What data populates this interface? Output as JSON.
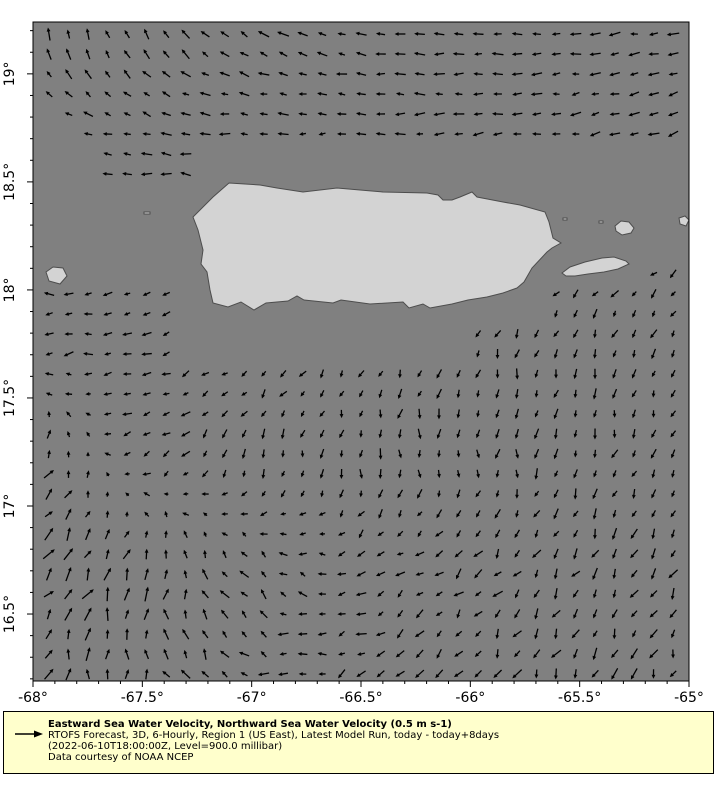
{
  "legend": {
    "title": "Eastward Sea Water Velocity, Northward Sea Water Velocity (0.5 m s-1)",
    "line2": "RTOFS Forecast, 3D, 6-Hourly, Region 1 (US East), Latest Model Run, today - today+8days",
    "line3": "(2022-06-10T18:00:00Z, Level=900.0 millibar)",
    "line4": "Data courtesy of NOAA NCEP",
    "arrow_icon": "quiver-key-arrow-icon"
  },
  "chart_data": {
    "type": "quiver",
    "title": "",
    "subtitle": "",
    "plot": {
      "left": 33,
      "top": 22,
      "width": 656,
      "height": 659
    },
    "x_axis": {
      "label": "",
      "range": [
        -68.0,
        -65.0
      ],
      "major_ticks": [
        -68,
        -67.5,
        -67,
        -66.5,
        -66,
        -65.5,
        -65
      ],
      "tick_labels": [
        "-68°",
        "-67.5°",
        "-67°",
        "-66.5°",
        "-66°",
        "-65.5°",
        "-65°"
      ],
      "minor_step": 0.1
    },
    "y_axis": {
      "label": "",
      "range": [
        16.19,
        19.24
      ],
      "major_ticks": [
        19,
        18.5,
        18,
        17.5,
        17,
        16.5
      ],
      "tick_labels": [
        "19°",
        "18.5°",
        "18°",
        "17.5°",
        "17°",
        "16.5°"
      ],
      "minor_step": 0.1
    },
    "grid": false,
    "colors": {
      "ocean": "#808080",
      "land": "#d3d3d3",
      "coastline": "#4d4d4d",
      "arrows": "#000000",
      "axis": "#000000",
      "legend_bg": "#ffffcc",
      "page_bg": "#ffffff"
    },
    "field": {
      "reference_vector_m_s": 0.5,
      "grid_start_px": [
        16,
        12
      ],
      "grid_step_px": [
        19.5,
        20
      ],
      "grid_cols": 33,
      "grid_rows": 33,
      "coarse_lons": [
        -68,
        -67.5,
        -67,
        -66.5,
        -66,
        -65.5,
        -65
      ],
      "coarse_lats": [
        19.2,
        18.7,
        18.2,
        17.7,
        17.2,
        16.7,
        16.2
      ],
      "angles_deg_ccw_from_east": [
        [
          95,
          120,
          150,
          170,
          180,
          185,
          190
        ],
        [
          160,
          172,
          180,
          183,
          188,
          192,
          200
        ],
        [
          175,
          180,
          185,
          188,
          195,
          205,
          215
        ],
        [
          185,
          195,
          215,
          240,
          255,
          255,
          248
        ],
        [
          60,
          210,
          250,
          270,
          268,
          258,
          248
        ],
        [
          48,
          70,
          130,
          200,
          228,
          238,
          244
        ],
        [
          75,
          105,
          165,
          215,
          235,
          245,
          252
        ]
      ],
      "rel_magnitude": [
        [
          0.7,
          0.65,
          0.6,
          0.55,
          0.55,
          0.55,
          0.6
        ],
        [
          0.6,
          0.55,
          0.5,
          0.5,
          0.5,
          0.5,
          0.55
        ],
        [
          0.5,
          0.45,
          0.4,
          0.4,
          0.4,
          0.45,
          0.5
        ],
        [
          0.5,
          0.45,
          0.45,
          0.45,
          0.5,
          0.5,
          0.5
        ],
        [
          0.75,
          0.5,
          0.5,
          0.5,
          0.5,
          0.5,
          0.5
        ],
        [
          0.95,
          0.85,
          0.6,
          0.5,
          0.55,
          0.6,
          0.6
        ],
        [
          0.8,
          0.75,
          0.55,
          0.5,
          0.6,
          0.6,
          0.6
        ]
      ]
    },
    "land": {
      "features": [
        {
          "name": "puerto-rico",
          "points": [
            [
              196,
              161
            ],
            [
              227,
              163
            ],
            [
              244,
              166
            ],
            [
              270,
              170
            ],
            [
              304,
              166
            ],
            [
              327,
              168
            ],
            [
              350,
              170
            ],
            [
              394,
              171
            ],
            [
              405,
              173
            ],
            [
              410,
              178
            ],
            [
              419,
              178
            ],
            [
              427,
              175
            ],
            [
              439,
              170
            ],
            [
              444,
              175
            ],
            [
              470,
              180
            ],
            [
              487,
              183
            ],
            [
              512,
              190
            ],
            [
              516,
              200
            ],
            [
              520,
              216
            ],
            [
              528,
              221
            ],
            [
              519,
              226
            ],
            [
              514,
              230
            ],
            [
              499,
              246
            ],
            [
              491,
              260
            ],
            [
              484,
              266
            ],
            [
              470,
              271
            ],
            [
              454,
              275
            ],
            [
              435,
              278
            ],
            [
              419,
              282
            ],
            [
              397,
              286
            ],
            [
              390,
              282
            ],
            [
              376,
              286
            ],
            [
              370,
              280
            ],
            [
              337,
              282
            ],
            [
              308,
              278
            ],
            [
              300,
              281
            ],
            [
              271,
              278
            ],
            [
              264,
              274
            ],
            [
              255,
              279
            ],
            [
              233,
              281
            ],
            [
              221,
              288
            ],
            [
              208,
              280
            ],
            [
              195,
              285
            ],
            [
              180,
              281
            ],
            [
              177,
              268
            ],
            [
              174,
              250
            ],
            [
              168,
              242
            ],
            [
              170,
              228
            ],
            [
              165,
              208
            ],
            [
              160,
              195
            ],
            [
              180,
              175
            ]
          ]
        },
        {
          "name": "vieques",
          "points": [
            [
              529,
              251
            ],
            [
              537,
              245
            ],
            [
              552,
              240
            ],
            [
              569,
              236
            ],
            [
              581,
              235
            ],
            [
              593,
              239
            ],
            [
              596,
              242
            ],
            [
              585,
              247
            ],
            [
              571,
              250
            ],
            [
              555,
              252
            ],
            [
              542,
              254
            ],
            [
              533,
              254
            ]
          ]
        },
        {
          "name": "culebra",
          "points": [
            [
              582,
              204
            ],
            [
              588,
              199
            ],
            [
              596,
              200
            ],
            [
              601,
              206
            ],
            [
              598,
              211
            ],
            [
              589,
              213
            ],
            [
              583,
              209
            ]
          ]
        },
        {
          "name": "east-islet",
          "points": [
            [
              646,
              196
            ],
            [
              652,
              194
            ],
            [
              656,
              198
            ],
            [
              653,
              204
            ],
            [
              647,
              202
            ]
          ]
        },
        {
          "name": "desecheo",
          "points": [
            [
              13,
              250
            ],
            [
              20,
              245
            ],
            [
              30,
              246
            ],
            [
              34,
              254
            ],
            [
              27,
              262
            ],
            [
              16,
              259
            ]
          ]
        },
        {
          "name": "islet-speck-1",
          "points": [
            [
              566,
              199
            ],
            [
              570,
              199
            ],
            [
              570,
              201
            ],
            [
              566,
              201
            ]
          ]
        },
        {
          "name": "islet-speck-2",
          "points": [
            [
              111,
              190
            ],
            [
              117,
              190
            ],
            [
              117,
              192
            ],
            [
              111,
              192
            ]
          ]
        },
        {
          "name": "islet-speck-3",
          "points": [
            [
              530,
              196
            ],
            [
              534,
              196
            ],
            [
              534,
              198
            ],
            [
              530,
              198
            ]
          ]
        }
      ]
    },
    "mask_polygons": [
      [
        [
          0,
          70
        ],
        [
          67,
          123
        ],
        [
          67,
          168
        ],
        [
          165,
          168
        ],
        [
          165,
          270
        ],
        [
          0,
          270
        ]
      ],
      [
        [
          165,
          128
        ],
        [
          656,
          128
        ],
        [
          656,
          250
        ],
        [
          522,
          250
        ],
        [
          522,
          310
        ],
        [
          445,
          310
        ],
        [
          445,
          346
        ],
        [
          150,
          346
        ],
        [
          150,
          270
        ],
        [
          165,
          270
        ]
      ],
      [
        [
          500,
          230
        ],
        [
          612,
          230
        ],
        [
          612,
          266
        ],
        [
          500,
          266
        ]
      ]
    ]
  }
}
